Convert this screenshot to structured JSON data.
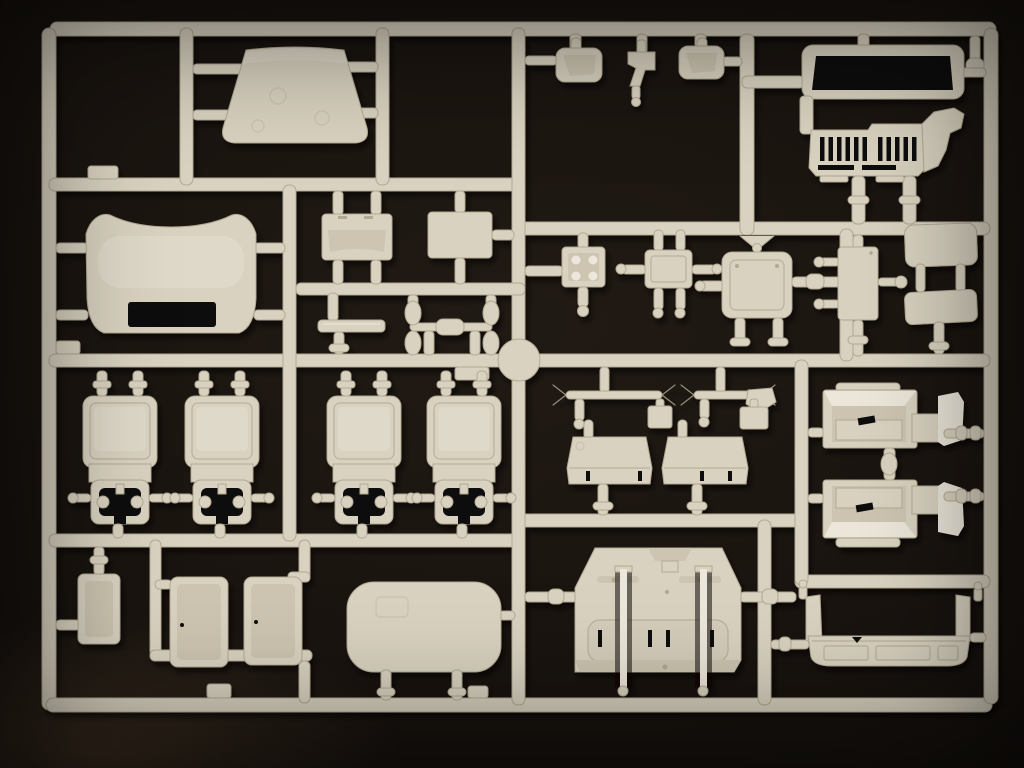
{
  "scene": {
    "description": "Photograph of an injection-moulded plastic sprue (parts tree) from a truck model kit: cream-coloured polystyrene parts attached to a rectangular runner frame, lying on a black background",
    "subject": "model-kit-sprue",
    "orientation": "landscape",
    "visible_text": ""
  },
  "palette": {
    "bg": "#17120e",
    "bg-edge": "#0c0a07",
    "plastic": "#d9d2c0",
    "plastic-light": "#ece7da",
    "plastic-mid": "#cdc5b1",
    "plastic-dark": "#b2a992",
    "hole": "#0e0b08",
    "shadow": "#050403"
  },
  "sprue": {
    "frame_shape": "rounded rectangle lattice with internal runners",
    "part_count_visible": 28,
    "parts": [
      {
        "id": "roof-cap",
        "label": "cab roof cap (trapezoid panel)"
      },
      {
        "id": "cab-rear-panel",
        "label": "cab rear panel with window opening"
      },
      {
        "id": "mirror-left",
        "label": "rear-view mirror housing"
      },
      {
        "id": "bracket-small",
        "label": "small angled bracket"
      },
      {
        "id": "mirror-right",
        "label": "rear-view mirror housing"
      },
      {
        "id": "cab-front",
        "label": "cab front with windscreen frame and slotted grille"
      },
      {
        "id": "dash-panel",
        "label": "dashboard strip"
      },
      {
        "id": "flat-panel",
        "label": "flat rectangular panel"
      },
      {
        "id": "sill-strip",
        "label": "thin sill strip"
      },
      {
        "id": "axle-winged",
        "label": "shaft with winged ends"
      },
      {
        "id": "box-four-holes",
        "label": "square box with four holes"
      },
      {
        "id": "tabbed-plate",
        "label": "plate with side pins"
      },
      {
        "id": "radiator",
        "label": "radiator core"
      },
      {
        "id": "door-panel",
        "label": "small rectangular panel"
      },
      {
        "id": "sun-visor-1",
        "label": "sun visor"
      },
      {
        "id": "sun-visor-2",
        "label": "sun visor"
      },
      {
        "id": "tie-rod-1",
        "label": "tie rod with forked ends"
      },
      {
        "id": "tie-rod-2",
        "label": "tie rod with forked ends"
      },
      {
        "id": "seat-cushion-1",
        "label": "seat cushion"
      },
      {
        "id": "seat-cushion-2",
        "label": "seat cushion"
      },
      {
        "id": "seat-back-1",
        "label": "seat back with mounting bracket"
      },
      {
        "id": "seat-back-2",
        "label": "seat back with mounting bracket"
      },
      {
        "id": "seat-back-3",
        "label": "seat back with mounting bracket"
      },
      {
        "id": "seat-back-4",
        "label": "seat back with mounting bracket"
      },
      {
        "id": "stowage-box",
        "label": "small open box"
      },
      {
        "id": "tray-1",
        "label": "open tray"
      },
      {
        "id": "tray-2",
        "label": "open tray"
      },
      {
        "id": "roof-panel",
        "label": "large rounded roof panel"
      },
      {
        "id": "floor-panel",
        "label": "cab floor panel with gear levers"
      },
      {
        "id": "step-unit-1",
        "label": "entry step / fender unit"
      },
      {
        "id": "step-unit-2",
        "label": "entry step / fender unit"
      },
      {
        "id": "front-bumper",
        "label": "front bumper"
      }
    ]
  }
}
